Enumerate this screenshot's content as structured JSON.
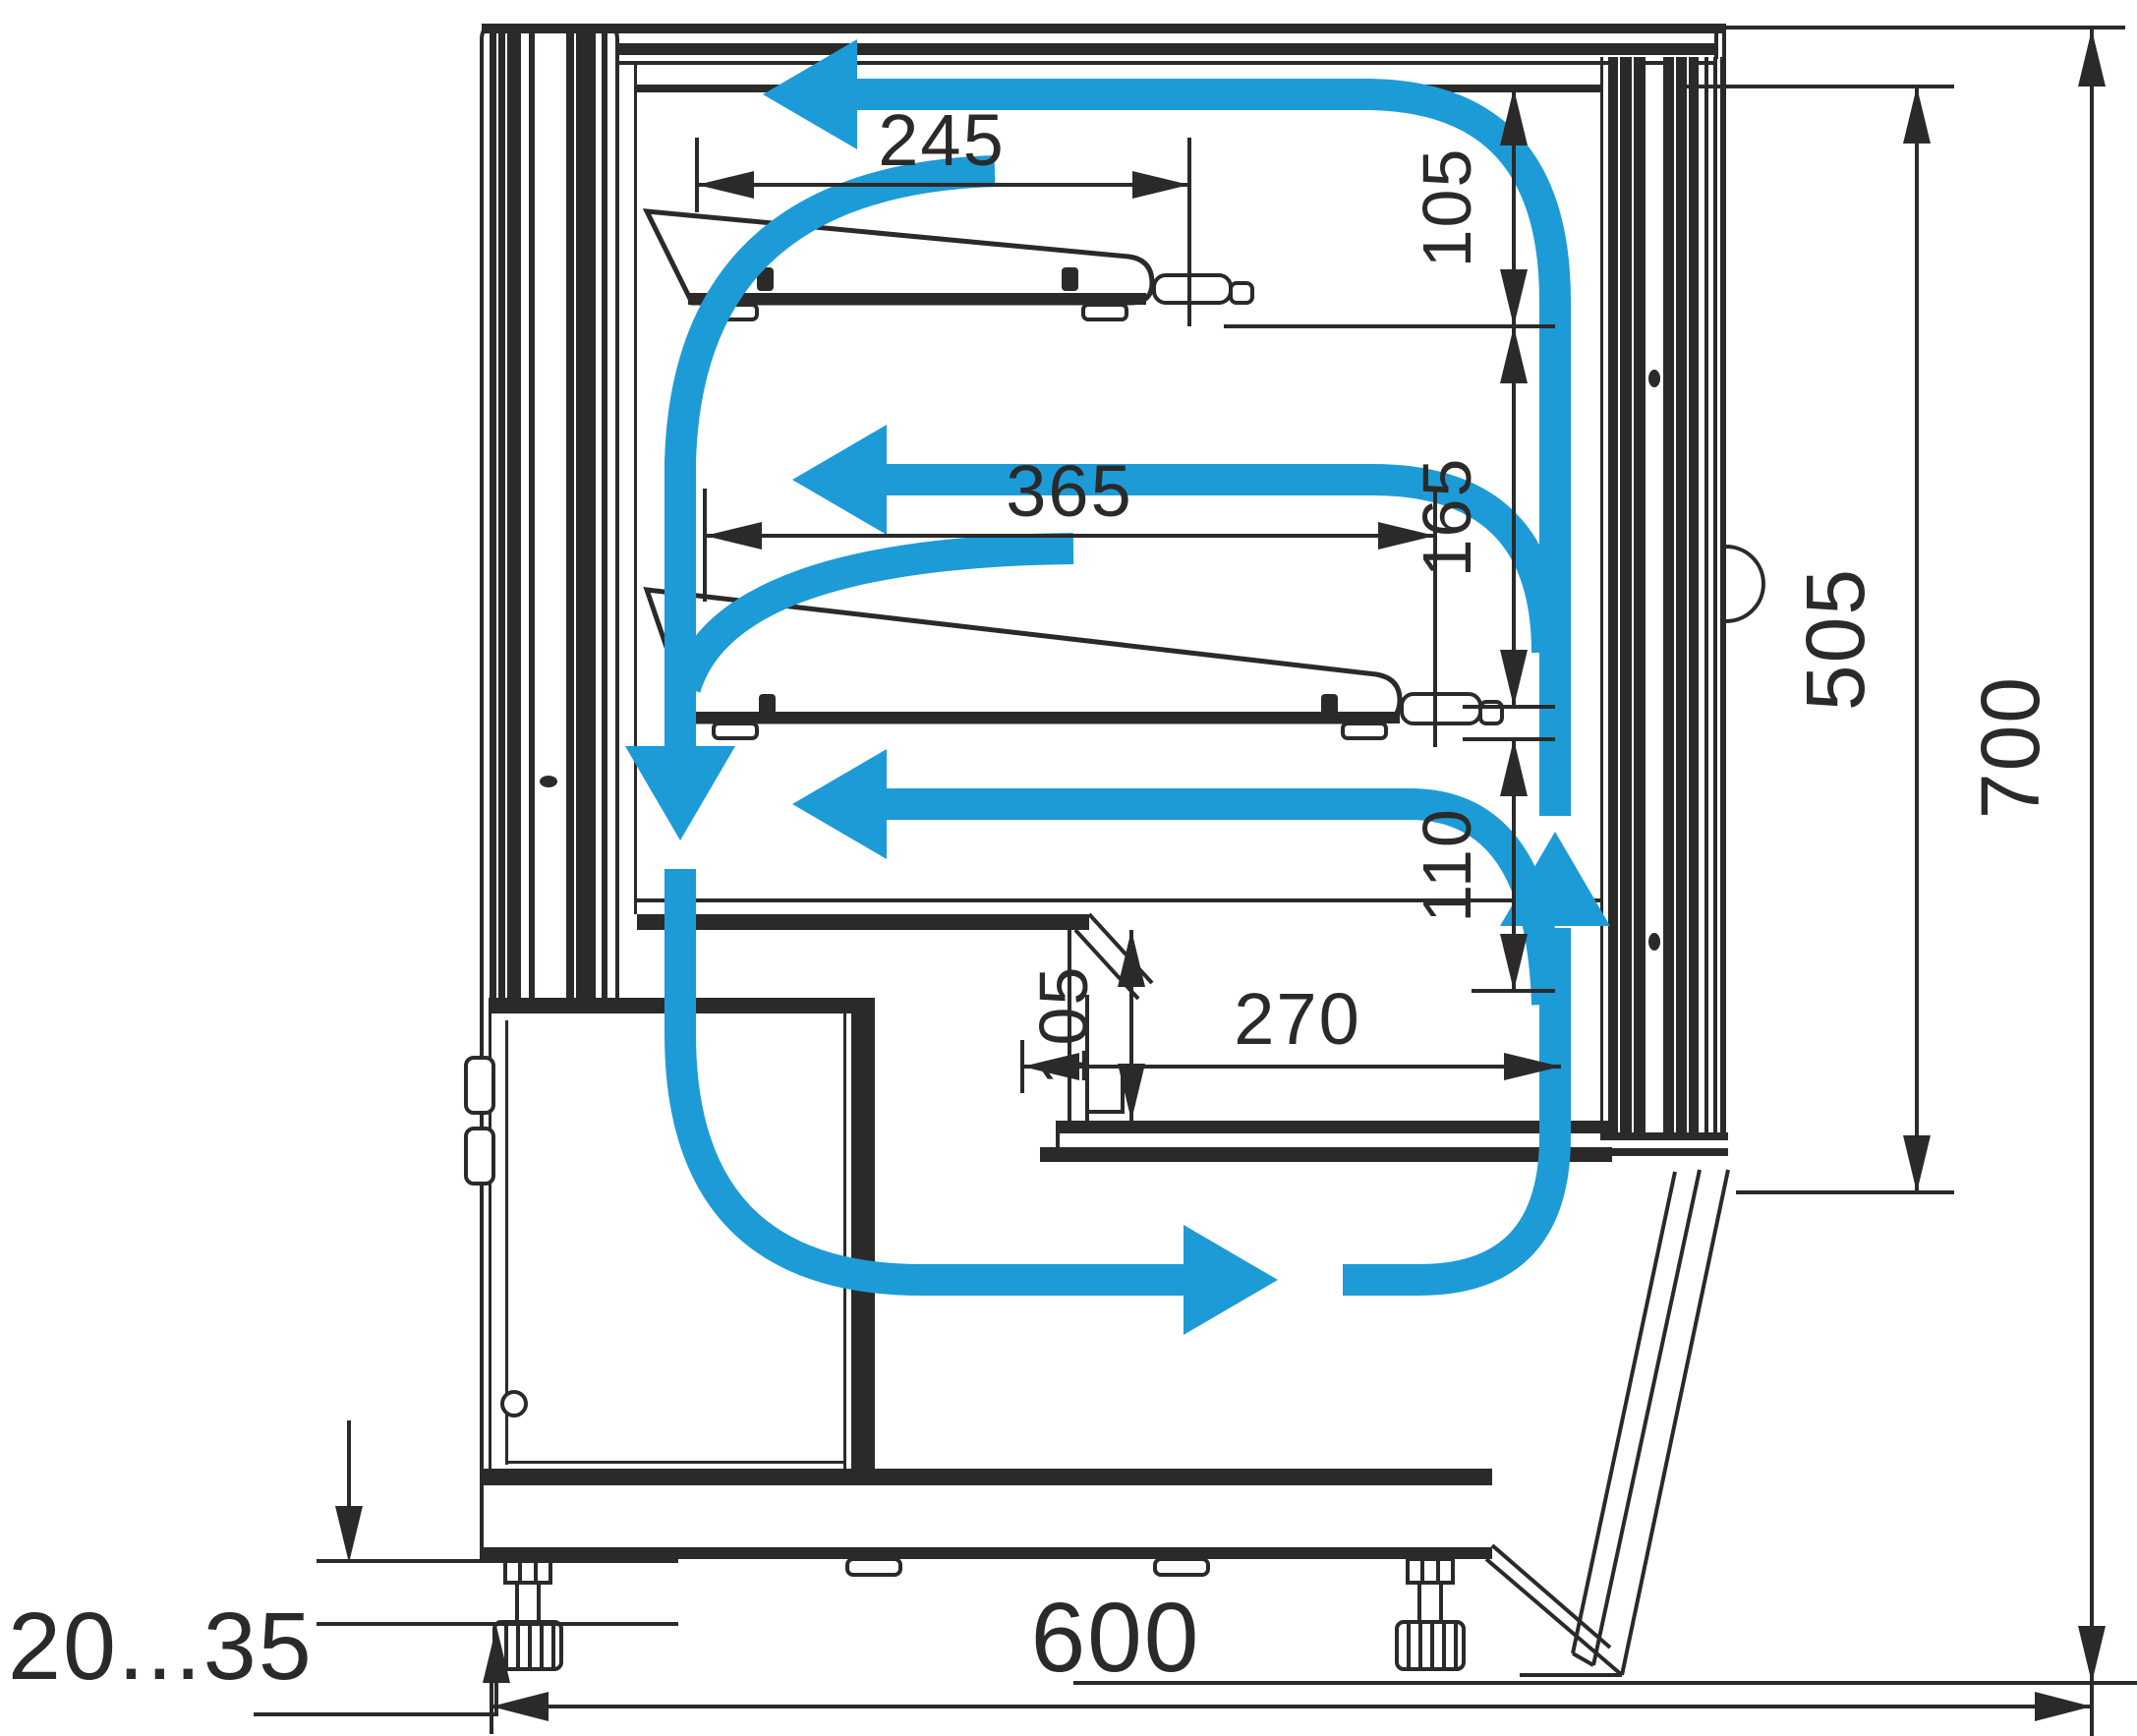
{
  "colors": {
    "line": "#2b2a29",
    "airflow": "#1d9bd7",
    "background": "#ffffff"
  },
  "dimensions": {
    "shelf_top_length": "245",
    "top_clearance": "105",
    "shelf_middle_length": "365",
    "middle_clearance": "165",
    "lower_clearance": "110",
    "well_depth": "105",
    "well_length": "270",
    "inner_height": "505",
    "overall_height": "700",
    "overall_depth": "600",
    "leg_adjustment_range": "20...35"
  },
  "icons": {
    "airflow_arrow": "filled-triangle-blue",
    "dimension_arrow": "filled-triangle-black"
  }
}
